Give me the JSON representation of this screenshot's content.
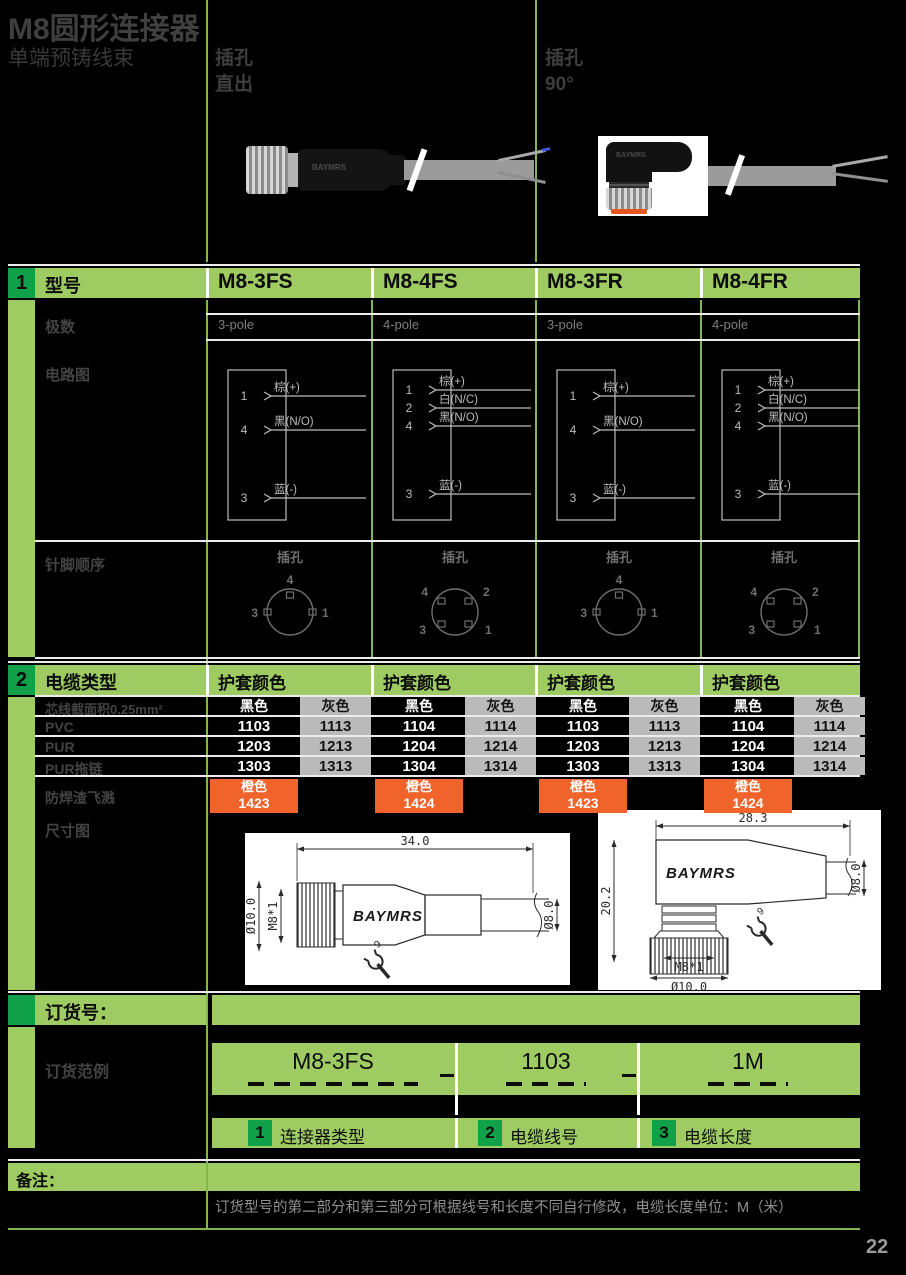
{
  "page": {
    "title": "M8圆形连接器",
    "subtitle": "单端预铸线束",
    "number": "22",
    "brand": "BAYMRS"
  },
  "top": {
    "straight_l1": "插孔",
    "straight_l2": "直出",
    "angled_l1": "插孔",
    "angled_l2": "90°"
  },
  "colors": {
    "band_green": "#9ecb62",
    "badge_green": "#12a14b",
    "grid_green": "#83b74b",
    "orange": "#f0642c",
    "gray_cell": "#bababa"
  },
  "model_section": {
    "badge": "1",
    "label": "型号",
    "models": [
      "M8-3FS",
      "M8-4FS",
      "M8-3FR",
      "M8-4FR"
    ],
    "poles_label": "极数",
    "poles": [
      "3-pole",
      "4-pole",
      "3-pole",
      "4-pole"
    ],
    "circuit_label": "电路图",
    "pin_label": "针脚顺序",
    "pin_caption": "插孔",
    "circuits": [
      {
        "pins": [
          "1",
          "4",
          "3"
        ],
        "wires": [
          "棕(+)",
          "黑(N/O)",
          "蓝(-)"
        ]
      },
      {
        "pins": [
          "1",
          "2",
          "4",
          "3"
        ],
        "wires": [
          "棕(+)",
          "白(N/C)",
          "黑(N/O)",
          "蓝(-)"
        ]
      },
      {
        "pins": [
          "1",
          "4",
          "3"
        ],
        "wires": [
          "棕(+)",
          "黑(N/O)",
          "蓝(-)"
        ]
      },
      {
        "pins": [
          "1",
          "2",
          "4",
          "3"
        ],
        "wires": [
          "棕(+)",
          "白(N/C)",
          "黑(N/O)",
          "蓝(-)"
        ]
      }
    ],
    "pin_diagrams": [
      {
        "type": "3p",
        "top": "4",
        "left": "3",
        "right": "1"
      },
      {
        "type": "4p",
        "tl": "4",
        "tr": "2",
        "bl": "3",
        "br": "1"
      },
      {
        "type": "3p",
        "top": "4",
        "left": "3",
        "right": "1"
      },
      {
        "type": "4p",
        "tl": "4",
        "tr": "2",
        "bl": "3",
        "br": "1"
      }
    ]
  },
  "cable_section": {
    "badge": "2",
    "label": "电缆类型",
    "jacket_header": "护套颜色",
    "col_headers": [
      "黑色",
      "灰色"
    ],
    "size_label": "芯线截面积0.25mm²",
    "rows": [
      {
        "label": "PVC",
        "cells": [
          [
            "1103",
            "1113"
          ],
          [
            "1104",
            "1114"
          ],
          [
            "1103",
            "1113"
          ],
          [
            "1104",
            "1114"
          ]
        ]
      },
      {
        "label": "PUR",
        "cells": [
          [
            "1203",
            "1213"
          ],
          [
            "1204",
            "1214"
          ],
          [
            "1203",
            "1213"
          ],
          [
            "1204",
            "1214"
          ]
        ]
      },
      {
        "label": "PUR拖链",
        "cells": [
          [
            "1303",
            "1313"
          ],
          [
            "1304",
            "1314"
          ],
          [
            "1303",
            "1313"
          ],
          [
            "1304",
            "1314"
          ]
        ]
      }
    ],
    "spatter": {
      "label": "防焊渣飞溅",
      "color_name": "橙色",
      "codes": [
        "1423",
        "1424",
        "1423",
        "1424"
      ]
    },
    "dim_label": "尺寸图",
    "dim_straight": {
      "length": "34.0",
      "outer_d": "Ø10.0",
      "thread": "M8*1",
      "cable_d": "Ø8.0",
      "wrench": "9"
    },
    "dim_angled": {
      "width": "28.3",
      "height": "20.2",
      "cable_d": "Ø8.0",
      "thread": "M8*1",
      "outer_d": "Ø10.0",
      "wrench": "9"
    }
  },
  "order_section": {
    "badge": "",
    "label": "订货号：",
    "example_label": "订货范例",
    "parts": [
      "M8-3FS",
      "1103",
      "1M"
    ],
    "legend": [
      {
        "num": "1",
        "label": "连接器类型"
      },
      {
        "num": "2",
        "label": "电缆线号"
      },
      {
        "num": "3",
        "label": "电缆长度"
      }
    ]
  },
  "note_section": {
    "label": "备注：",
    "text": "订货型号的第二部分和第三部分可根据线号和长度不同自行修改，电缆长度单位：M（米）"
  }
}
